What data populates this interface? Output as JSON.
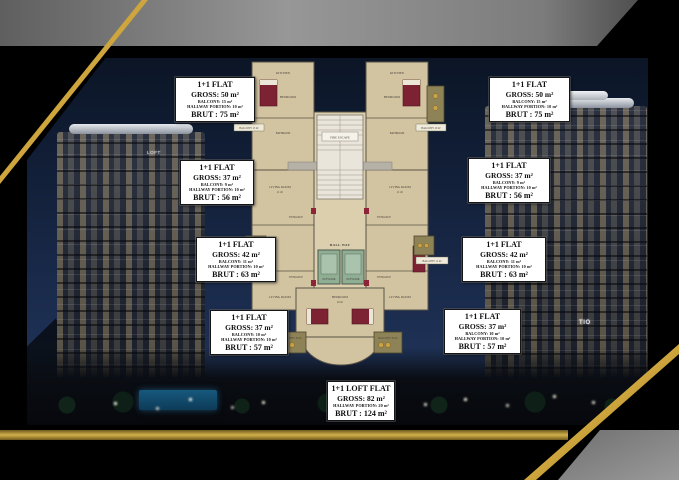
{
  "scene": {
    "left_tower_sign": "LOFT",
    "right_tower_sign": "TIO"
  },
  "plan": {
    "rooms": {
      "fire_escape": "FIRE ESCAPE",
      "hall_way": "HALL WAY",
      "elevator_left": "ELEVATOR",
      "elevator_right": "ELEVATOR",
      "kitchen": "KITCHEN",
      "bedroom": "BEDROOM",
      "bathroom": "BATHROOM",
      "entrance": "ENTRANCE",
      "living_room": "LIVING ROOM",
      "living_room_area": "21 m²",
      "bedroom_bottom": "BEDROOM",
      "bedroom_bottom_area": "20 m²",
      "balcony_top_left": "BALCONY 15 m²",
      "balcony_top_right": "BALCONY 15 m²",
      "balcony_mid_left": "BALCONY 11 m²",
      "balcony_mid_right": "BALCONY 11 m²",
      "balcony_bottom_left": "BALCONY 10 m²",
      "balcony_bottom_right": "BALCONY 10 m²"
    }
  },
  "info_boxes": [
    {
      "title": "1+1 FLAT",
      "gross": "GROSS: 50 m²",
      "balcony": "BALCONY: 15 m²",
      "hallway": "HALLWAY PORTION: 10 m²",
      "brut": "BRUT : 75 m²"
    },
    {
      "title": "1+1 FLAT",
      "gross": "GROSS: 50 m²",
      "balcony": "BALCONY: 15 m²",
      "hallway": "HALLWAY PORTION: 10 m²",
      "brut": "BRUT : 75 m²"
    },
    {
      "title": "1+1 FLAT",
      "gross": "GROSS: 37 m²",
      "balcony": "BALCONY: 9 m²",
      "hallway": "HALLWAY PORTION: 10 m²",
      "brut": "BRUT : 56 m²"
    },
    {
      "title": "1+1 FLAT",
      "gross": "GROSS: 37 m²",
      "balcony": "BALCONY: 9 m²",
      "hallway": "HALLWAY PORTION: 10 m²",
      "brut": "BRUT : 56 m²"
    },
    {
      "title": "1+1 FLAT",
      "gross": "GROSS: 42 m²",
      "balcony": "BALCONY: 11 m²",
      "hallway": "HALLWAY PORTION: 10 m²",
      "brut": "BRUT : 63 m²"
    },
    {
      "title": "1+1 FLAT",
      "gross": "GROSS: 42 m²",
      "balcony": "BALCONY: 11 m²",
      "hallway": "HALLWAY PORTION: 10 m²",
      "brut": "BRUT : 63 m²"
    },
    {
      "title": "1+1 FLAT",
      "gross": "GROSS: 37 m²",
      "balcony": "BALCONY: 10 m²",
      "hallway": "HALLWAY PORTION: 10 m²",
      "brut": "BRUT : 57 m²"
    },
    {
      "title": "1+1 FLAT",
      "gross": "GROSS: 37 m²",
      "balcony": "BALCONY: 10 m²",
      "hallway": "HALLWAY PORTION: 10 m²",
      "brut": "BRUT : 57 m²"
    },
    {
      "title": "1+1 LOFT FLAT",
      "gross": "GROSS: 82 m²",
      "hallway": "HALLWAY PORTION: 20 m²",
      "brut": "BRUT : 124 m²"
    }
  ],
  "colors": {
    "frame_gold": "#c2a03a",
    "frame_gray": "#8f8f8f",
    "plan_beige": "#d3c4a1",
    "elevator_green": "#8fae94",
    "furniture_maroon": "#7d2233",
    "sky_navy": "#14223d"
  }
}
